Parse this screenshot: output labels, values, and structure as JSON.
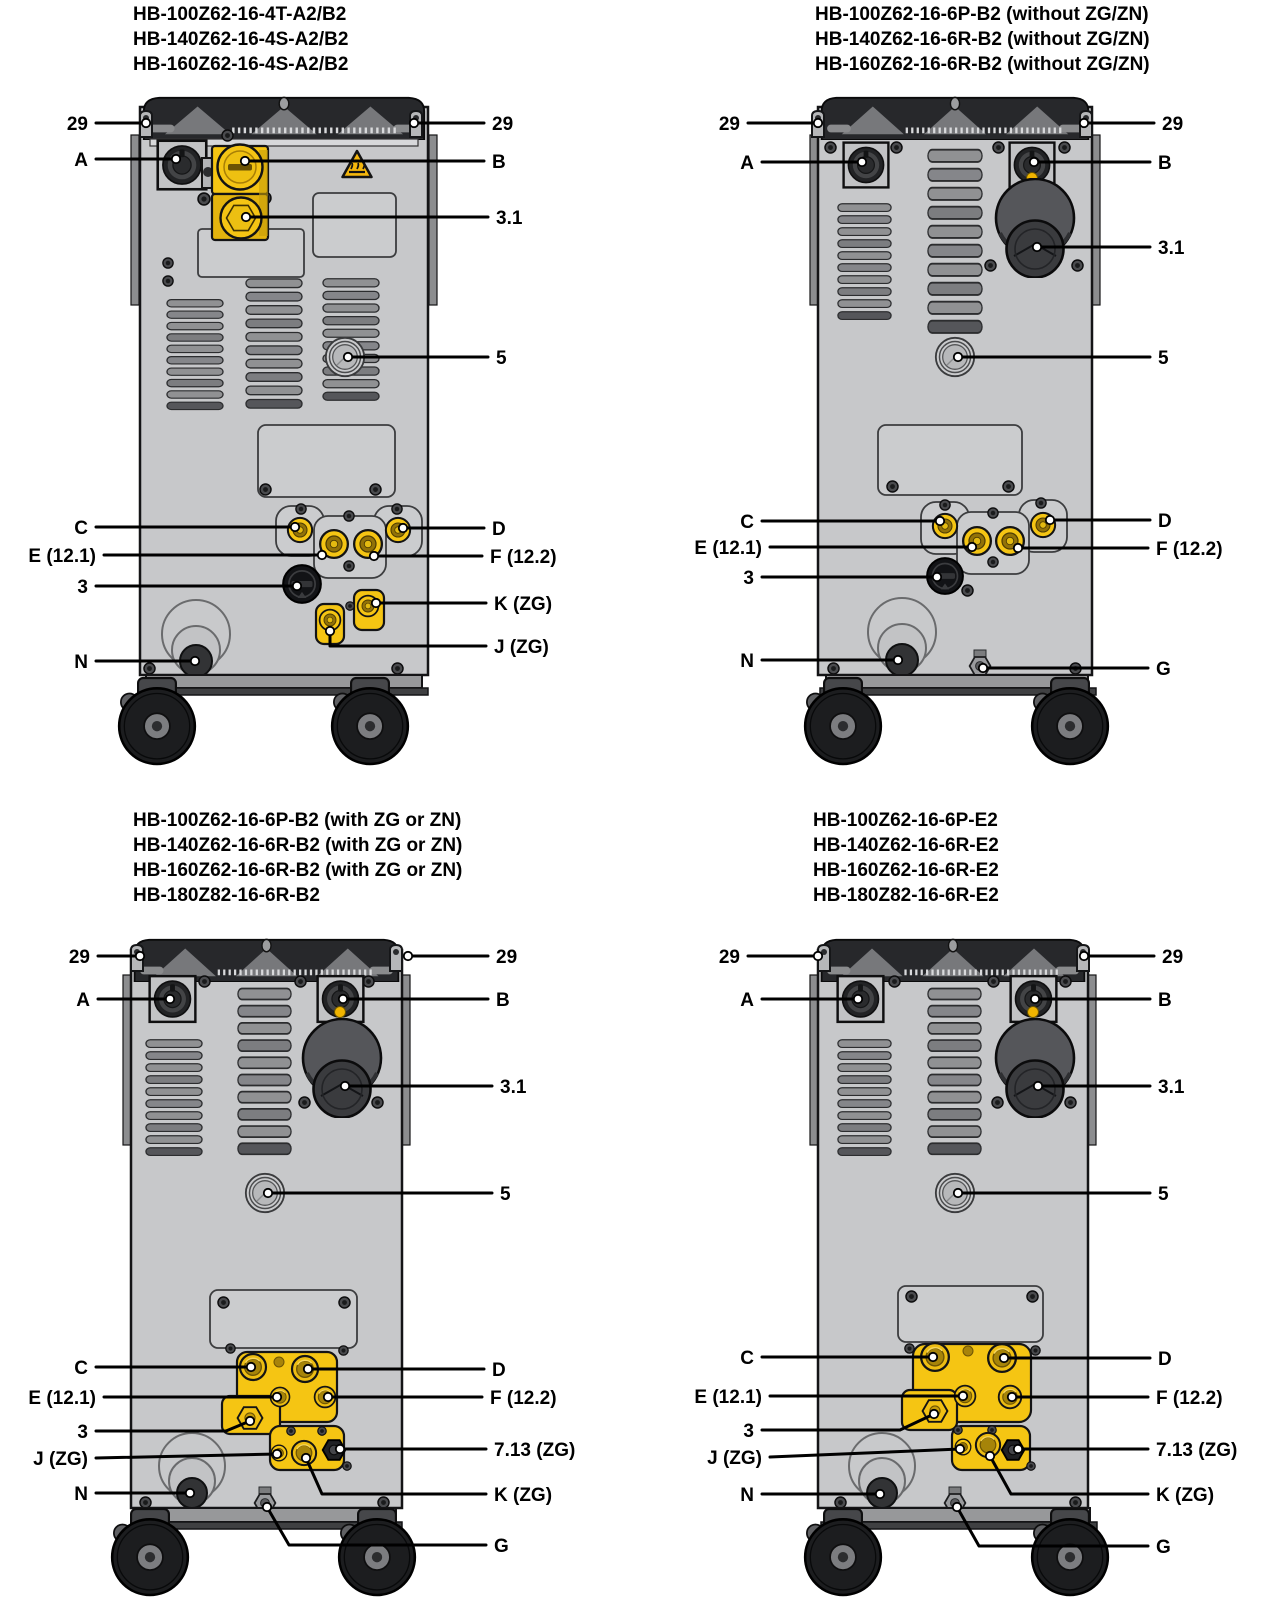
{
  "figure": {
    "description_visible": false
  },
  "colors": {
    "machine_yellow": "#F5C513",
    "brass": "#A68409",
    "body_gray": "#C7C8CA",
    "dark_gray": "#1C1D1F",
    "warning_yellow": "#F5B70C",
    "outline": "#000000",
    "background": "#FFFFFF"
  },
  "panels": [
    {
      "id": "top-left",
      "title_lines": [
        "HB-100Z62-16-4T-A2/B2",
        "HB-140Z62-16-4S-A2/B2",
        "HB-160Z62-16-4S-A2/B2"
      ],
      "callouts": [
        {
          "label": "29"
        },
        {
          "label": "29"
        },
        {
          "label": "A"
        },
        {
          "label": "B"
        },
        {
          "label": "3.1"
        },
        {
          "label": "5"
        },
        {
          "label": "C"
        },
        {
          "label": "D"
        },
        {
          "label": "E (12.1)"
        },
        {
          "label": "F (12.2)"
        },
        {
          "label": "3"
        },
        {
          "label": "K (ZG)"
        },
        {
          "label": "J (ZG)"
        },
        {
          "label": "N"
        }
      ]
    },
    {
      "id": "top-right",
      "title_lines": [
        "HB-100Z62-16-6P-B2 (without ZG/ZN)",
        "HB-140Z62-16-6R-B2 (without ZG/ZN)",
        "HB-160Z62-16-6R-B2 (without ZG/ZN)"
      ],
      "callouts": [
        {
          "label": "29"
        },
        {
          "label": "29"
        },
        {
          "label": "A"
        },
        {
          "label": "B"
        },
        {
          "label": "3.1"
        },
        {
          "label": "5"
        },
        {
          "label": "C"
        },
        {
          "label": "D"
        },
        {
          "label": "E (12.1)"
        },
        {
          "label": "F (12.2)"
        },
        {
          "label": "3"
        },
        {
          "label": "N"
        },
        {
          "label": "G"
        }
      ]
    },
    {
      "id": "bottom-left",
      "title_lines": [
        "HB-100Z62-16-6P-B2 (with ZG or ZN)",
        "HB-140Z62-16-6R-B2 (with ZG or ZN)",
        "HB-160Z62-16-6R-B2 (with ZG or ZN)",
        "HB-180Z82-16-6R-B2"
      ],
      "callouts": [
        {
          "label": "29"
        },
        {
          "label": "29"
        },
        {
          "label": "A"
        },
        {
          "label": "B"
        },
        {
          "label": "3.1"
        },
        {
          "label": "5"
        },
        {
          "label": "C"
        },
        {
          "label": "D"
        },
        {
          "label": "E (12.1)"
        },
        {
          "label": "F (12.2)"
        },
        {
          "label": "3"
        },
        {
          "label": "7.13 (ZG)"
        },
        {
          "label": "J (ZG)"
        },
        {
          "label": "N"
        },
        {
          "label": "K (ZG)"
        },
        {
          "label": "G"
        }
      ]
    },
    {
      "id": "bottom-right",
      "title_lines": [
        "HB-100Z62-16-6P-E2",
        "HB-140Z62-16-6R-E2",
        "HB-160Z62-16-6R-E2",
        "HB-180Z82-16-6R-E2"
      ],
      "callouts": [
        {
          "label": "29"
        },
        {
          "label": "29"
        },
        {
          "label": "A"
        },
        {
          "label": "B"
        },
        {
          "label": "3.1"
        },
        {
          "label": "5"
        },
        {
          "label": "C"
        },
        {
          "label": "D"
        },
        {
          "label": "E (12.1)"
        },
        {
          "label": "F (12.2)"
        },
        {
          "label": "3"
        },
        {
          "label": "J (ZG)"
        },
        {
          "label": "7.13 (ZG)"
        },
        {
          "label": "N"
        },
        {
          "label": "K (ZG)"
        },
        {
          "label": "G"
        }
      ]
    }
  ]
}
